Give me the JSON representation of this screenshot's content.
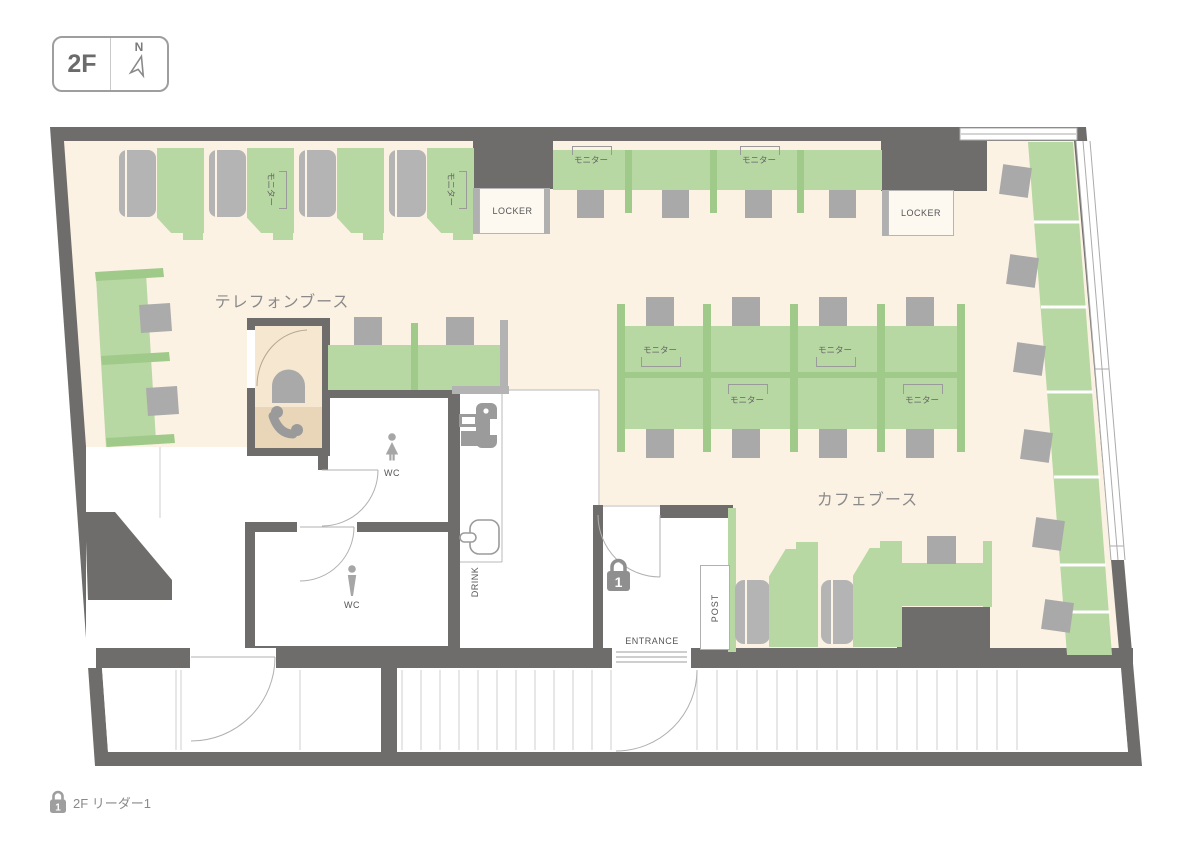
{
  "legend_box": {
    "floor": "2F",
    "north": "N"
  },
  "area_labels": {
    "telephone_booth": "テレフォンブース",
    "cafe_booth": "カフェブース"
  },
  "labels": {
    "monitor": "モニター",
    "locker": "LOCKER",
    "wc": "WC",
    "drink": "DRINK",
    "entrance": "ENTRANCE",
    "post": "POST"
  },
  "entrance": {
    "lock_number": "1"
  },
  "footer": {
    "lock_number": "1",
    "reader_label": "2F リーダー1"
  },
  "icons": {
    "north_arrow": "outlined navigation needle",
    "entrance_lock": "padlock with number 1",
    "footer_lock": "padlock with number 1",
    "phone": "telephone handset",
    "printer": "multifunction printer",
    "kettle": "drink server pot",
    "wc_female": "woman figure",
    "wc_male": "man figure"
  },
  "colors": {
    "wall": "#6f6d6b",
    "floor": "#fcf2e4",
    "desk_green": "#b7d7a3",
    "divider_green": "#a0ca89",
    "chair_gray": "#a9a9a9",
    "booth_floor_top": "#f5e7d0",
    "booth_floor_bottom": "#e9d6b9"
  }
}
